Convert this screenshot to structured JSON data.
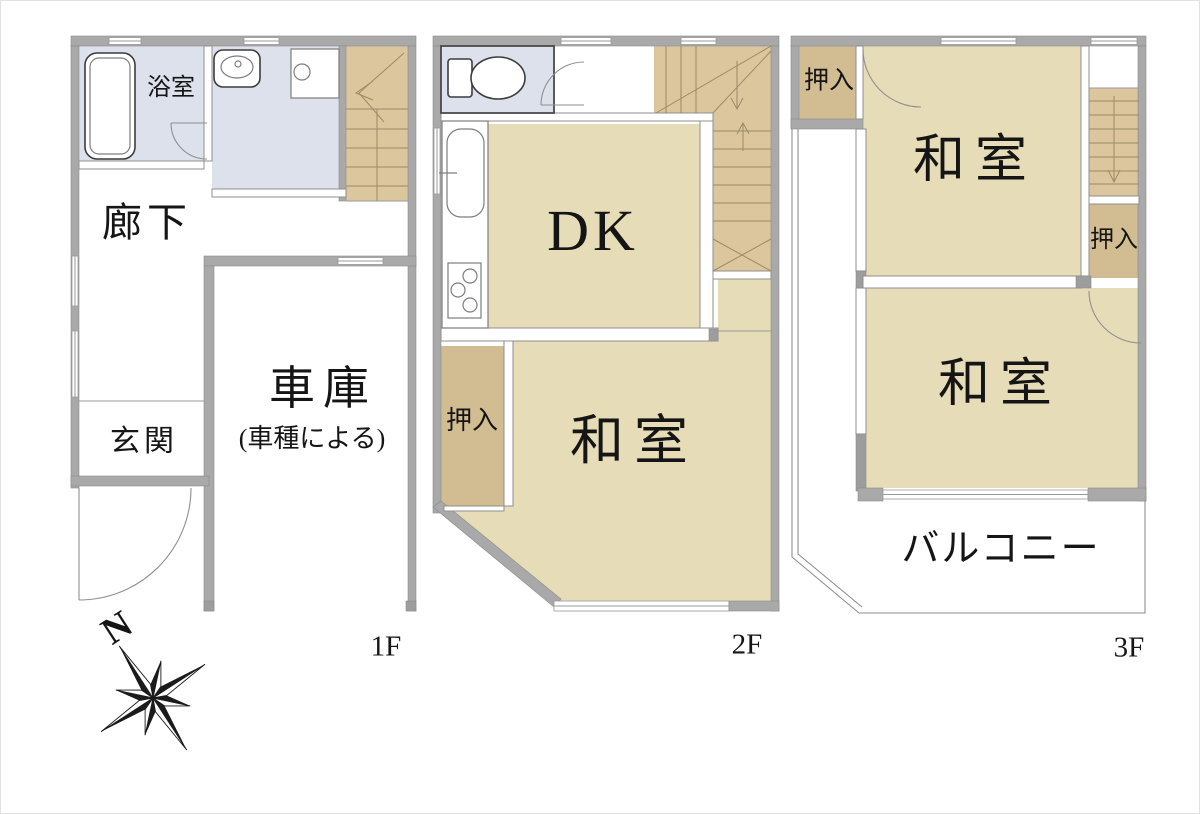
{
  "compass": {
    "north": "N"
  },
  "floor1": {
    "label": "1F",
    "bathroom": "浴室",
    "hallway": "廊下",
    "entrance": "玄関",
    "garage": "車庫",
    "garage_note": "(車種による)"
  },
  "floor2": {
    "label": "2F",
    "dk": "DK",
    "closet": "押入",
    "washitsu": "和室"
  },
  "floor3": {
    "label": "3F",
    "closet_a": "押入",
    "washitsu_a": "和室",
    "closet_b": "押入",
    "washitsu_b": "和室",
    "balcony": "バルコニー"
  },
  "colors": {
    "room_tan": "#e7dcb8",
    "closet_tan": "#d2bc92",
    "stairs_tan": "#dcc69d",
    "wet_area_blue": "#dce1ec",
    "wall_gray": "#a9a9a9"
  }
}
